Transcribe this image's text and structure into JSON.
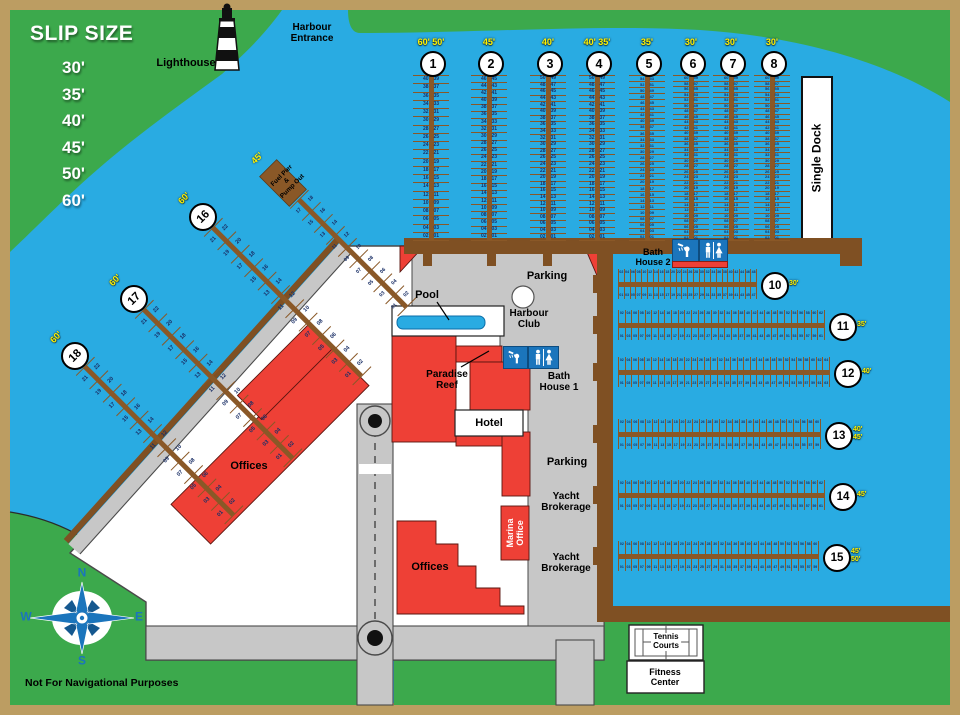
{
  "legend": {
    "title": "SLIP SIZE",
    "sizes": [
      "30'",
      "35'",
      "40'",
      "45'",
      "50'",
      "60'"
    ]
  },
  "labels": {
    "lighthouse": "Lighthouse",
    "harbour_entrance": "Harbour\nEntrance",
    "single_dock": "Single Dock",
    "parking_north": "Parking",
    "parking_east": "Parking",
    "pool": "Pool",
    "harbour_club": "Harbour\nClub",
    "paradise_reef": "Paradise\nReef",
    "bath_house_1": "Bath\nHouse 1",
    "bath_house_2": "Bath\nHouse 2",
    "hotel": "Hotel",
    "offices_west": "Offices",
    "offices_south": "Offices",
    "marina_office": "Marina\nOffice",
    "yacht_brokerage_1": "Yacht\nBrokerage",
    "yacht_brokerage_2": "Yacht\nBrokerage",
    "tennis_courts": "Tennis\nCourts",
    "fitness_center": "Fitness\nCenter",
    "disclaimer": "Not For Navigational Purposes"
  },
  "compass": {
    "n": "N",
    "e": "E",
    "s": "S",
    "w": "W"
  },
  "docks": [
    {
      "id": "1",
      "number": "1",
      "sizes": "60'  50'",
      "slips": 40
    },
    {
      "id": "2",
      "number": "2",
      "sizes": "45'",
      "slips": 46
    },
    {
      "id": "3",
      "number": "3",
      "sizes": "40'",
      "slips": 50
    },
    {
      "id": "4",
      "number": "4",
      "sizes": "40'  35'",
      "slips": 50
    },
    {
      "id": "5",
      "number": "5",
      "sizes": "35'",
      "slips": 54
    },
    {
      "id": "6",
      "number": "6",
      "sizes": "30'",
      "slips": 60
    },
    {
      "id": "7",
      "number": "7",
      "sizes": "30'",
      "slips": 60
    },
    {
      "id": "8",
      "number": "8",
      "sizes": "30'",
      "slips": 60
    },
    {
      "id": "10",
      "number": "10",
      "sizes": "30'",
      "slips": 48
    },
    {
      "id": "11",
      "number": "11",
      "sizes": "35'",
      "slips": 62
    },
    {
      "id": "12",
      "number": "12",
      "sizes": "40'",
      "slips": 64
    },
    {
      "id": "13",
      "number": "13",
      "sizes": "40'\n45'",
      "slips": 60
    },
    {
      "id": "14",
      "number": "14",
      "sizes": "45'",
      "slips": 62
    },
    {
      "id": "15",
      "number": "15",
      "sizes": "45'\n50'",
      "slips": 60
    },
    {
      "id": "16",
      "number": "16",
      "sizes": "60'",
      "slips": 22
    },
    {
      "id": "17",
      "number": "17",
      "sizes": "60'",
      "slips": 22
    },
    {
      "id": "18",
      "number": "18",
      "sizes": "60'",
      "slips": 22
    },
    {
      "id": "fuel",
      "number": "",
      "name": "Fuel Pier\n&\nPump Out",
      "sizes": "45'",
      "slips": 18
    }
  ],
  "colors": {
    "water": "#29ABE2",
    "grass": "#3CA94C",
    "dock_brown": "#8A5827",
    "bulkhead_brown": "#7F5023",
    "building_red": "#EE4036",
    "road_gray": "#C7C7C7",
    "frame_tan": "#BC9D62",
    "label_yellow": "#FFF200",
    "icon_blue": "#1B75BC"
  }
}
